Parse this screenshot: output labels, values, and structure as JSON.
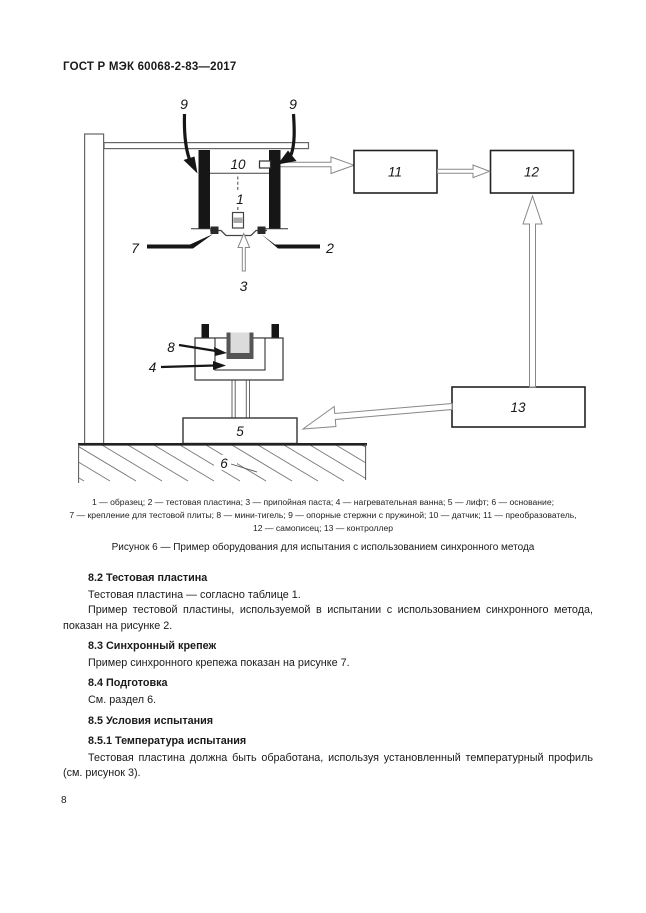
{
  "page": {
    "header": "ГОСТ Р МЭК 60068-2-83—2017",
    "page_number": "8"
  },
  "figure": {
    "labels": {
      "l1": "1",
      "l2": "2",
      "l3": "3",
      "l4": "4",
      "l5": "5",
      "l6": "6",
      "l7": "7",
      "l8": "8",
      "l9": "9",
      "l10": "10",
      "l11": "11",
      "l12": "12",
      "l13": "13"
    },
    "legend_lines": [
      "1 — образец; 2 — тестовая пластина; 3 — припойная паста; 4 — нагревательная ванна; 5 — лифт; 6 — основание;",
      "7 — крепление для тестовой плиты; 8 — мини-тигель; 9 — опорные стержни с пружиной; 10 — датчик; 11 — преобразователь,",
      "12 — самописец; 13 — контроллер"
    ],
    "caption": "Рисунок 6 — Пример оборудования для испытания с использованием синхронного метода"
  },
  "content": {
    "s82": {
      "title": "8.2 Тестовая пластина",
      "p1": "Тестовая пластина — согласно таблице 1.",
      "p2": "Пример тестовой пластины, используемой в испытании с использованием синхронного метода, показан на рисунке 2."
    },
    "s83": {
      "title": "8.3 Синхронный крепеж",
      "p1": "Пример синхронного крепежа показан на рисунке 7."
    },
    "s84": {
      "title": "8.4 Подготовка",
      "p1": "См. раздел 6."
    },
    "s85": {
      "title": "8.5 Условия испытания"
    },
    "s851": {
      "title": "8.5.1 Температура испытания",
      "p1": "Тестовая пластина должна быть обработана, используя установленный температурный профиль (см. рисунок 3)."
    }
  },
  "colors": {
    "paper": "#ffffff",
    "ink": "#1a1a1a",
    "rod_black": "#161616",
    "line_gray": "#888888",
    "crucible_wall": "#555555",
    "crucible_fill": "#dcdcdc"
  }
}
